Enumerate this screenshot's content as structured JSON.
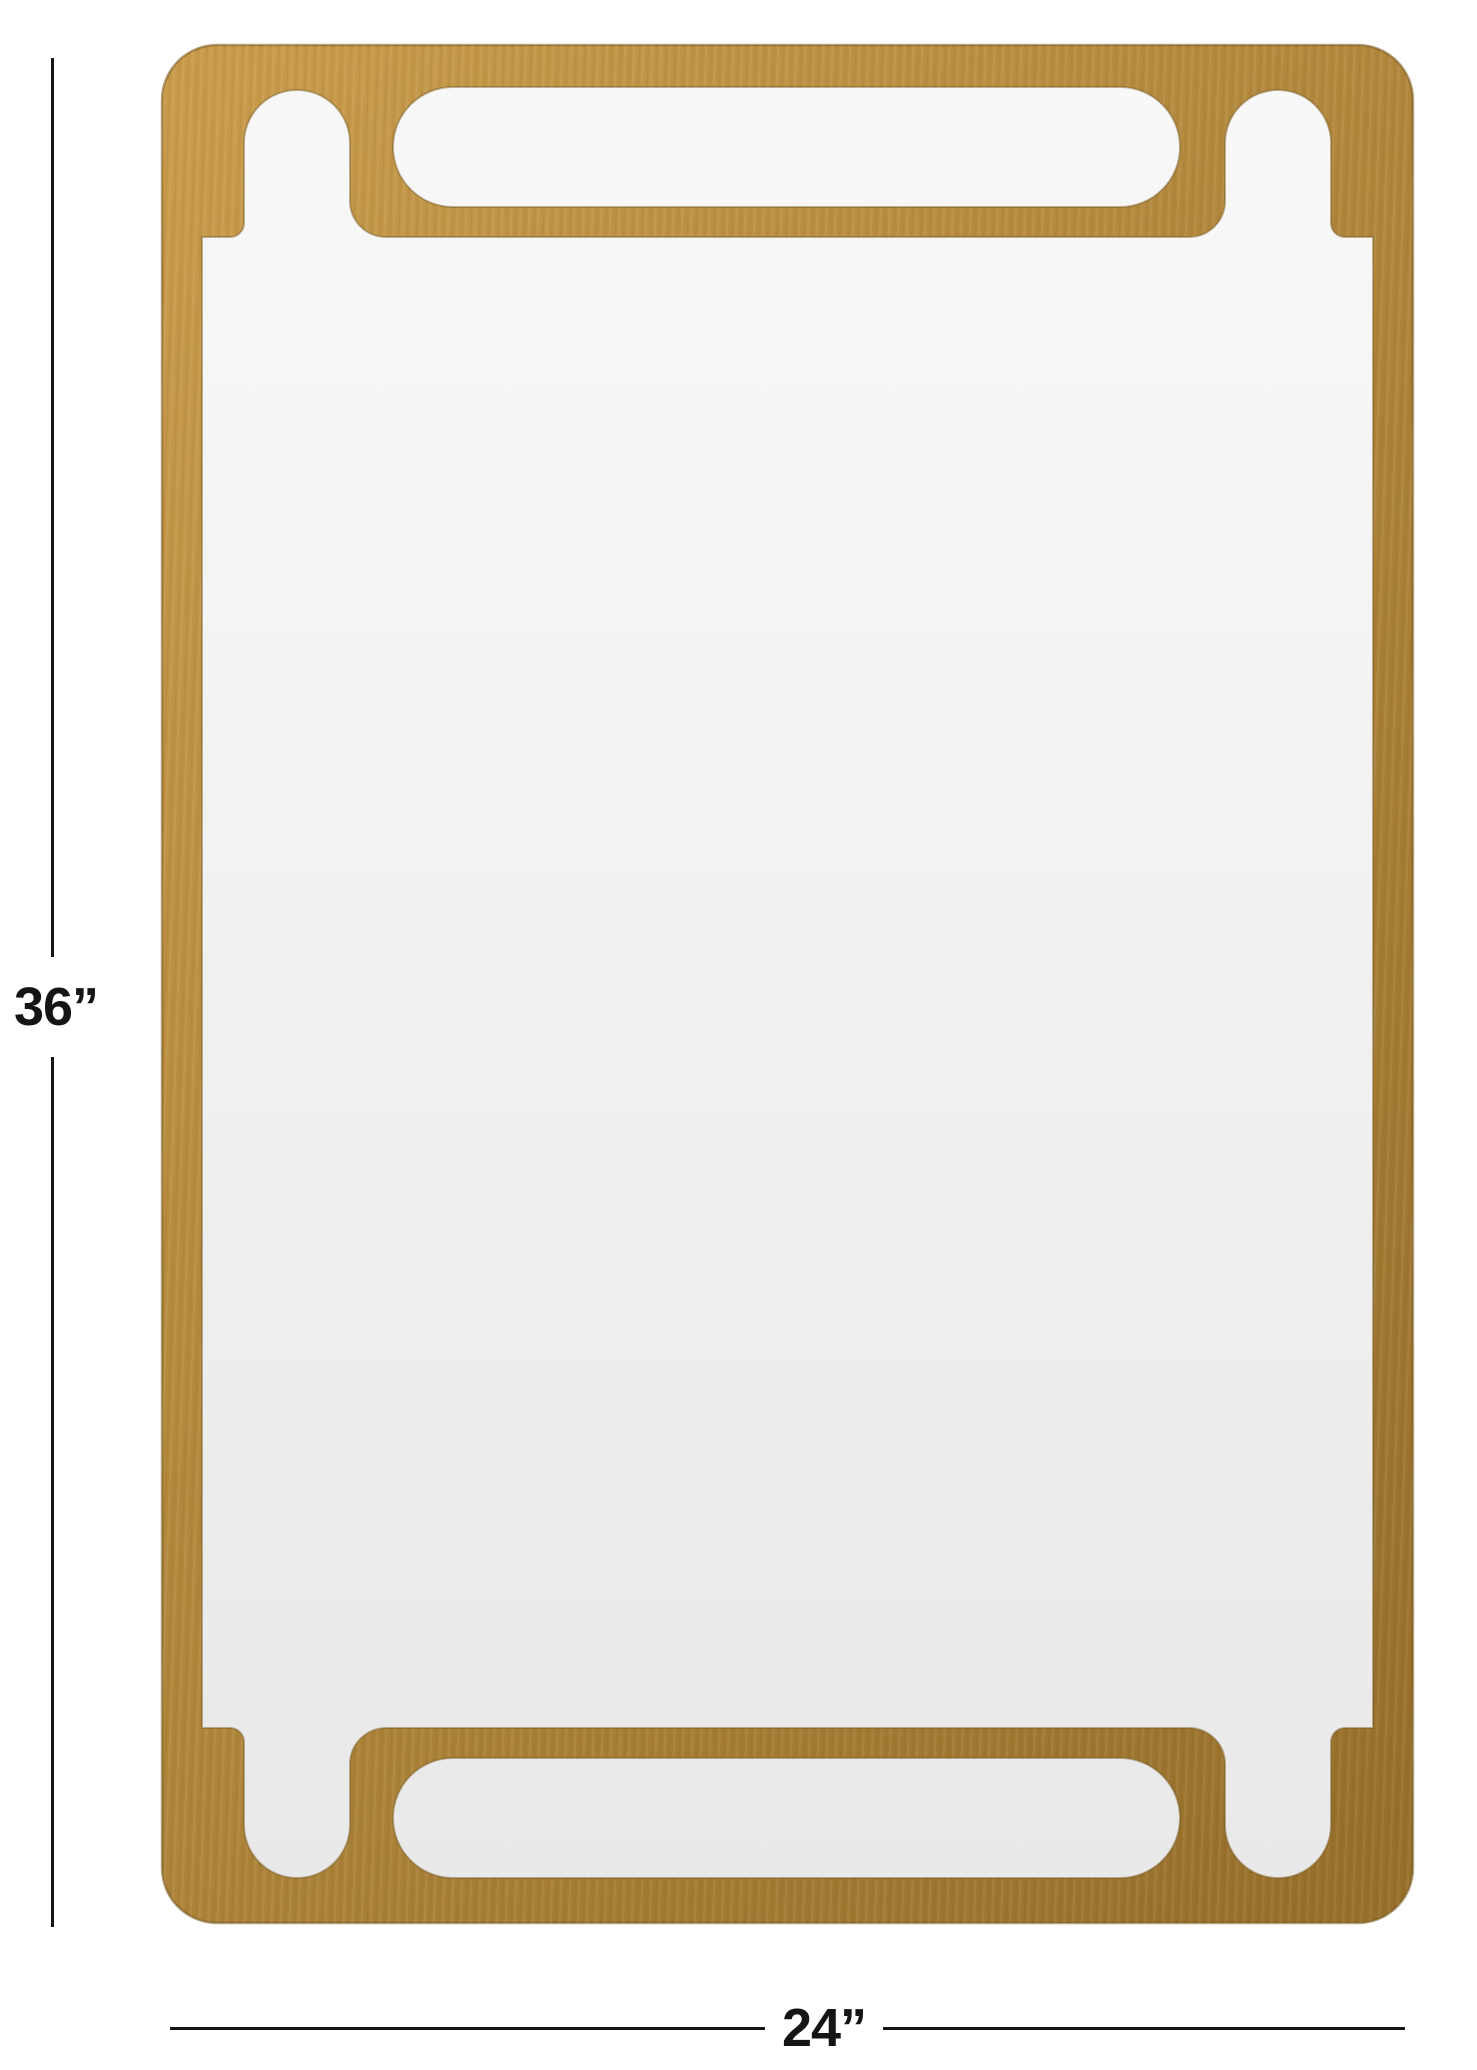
{
  "diagram": {
    "alt_description": "Rectangular brass-finish wall mirror with stadium and arch cutout frame, shown with height and width dimension annotations",
    "height_label": "36”",
    "width_label": "24”"
  },
  "colors": {
    "page_background": "#ffffff",
    "frame_gold_light": "#c89b4b",
    "frame_gold_mid": "#b1873c",
    "frame_gold_dark": "#97702b",
    "frame_outline": "#76591f",
    "glass_light": "#f8f8f8",
    "glass_dark": "#e9e9e9",
    "dimension_line": "#151515"
  }
}
